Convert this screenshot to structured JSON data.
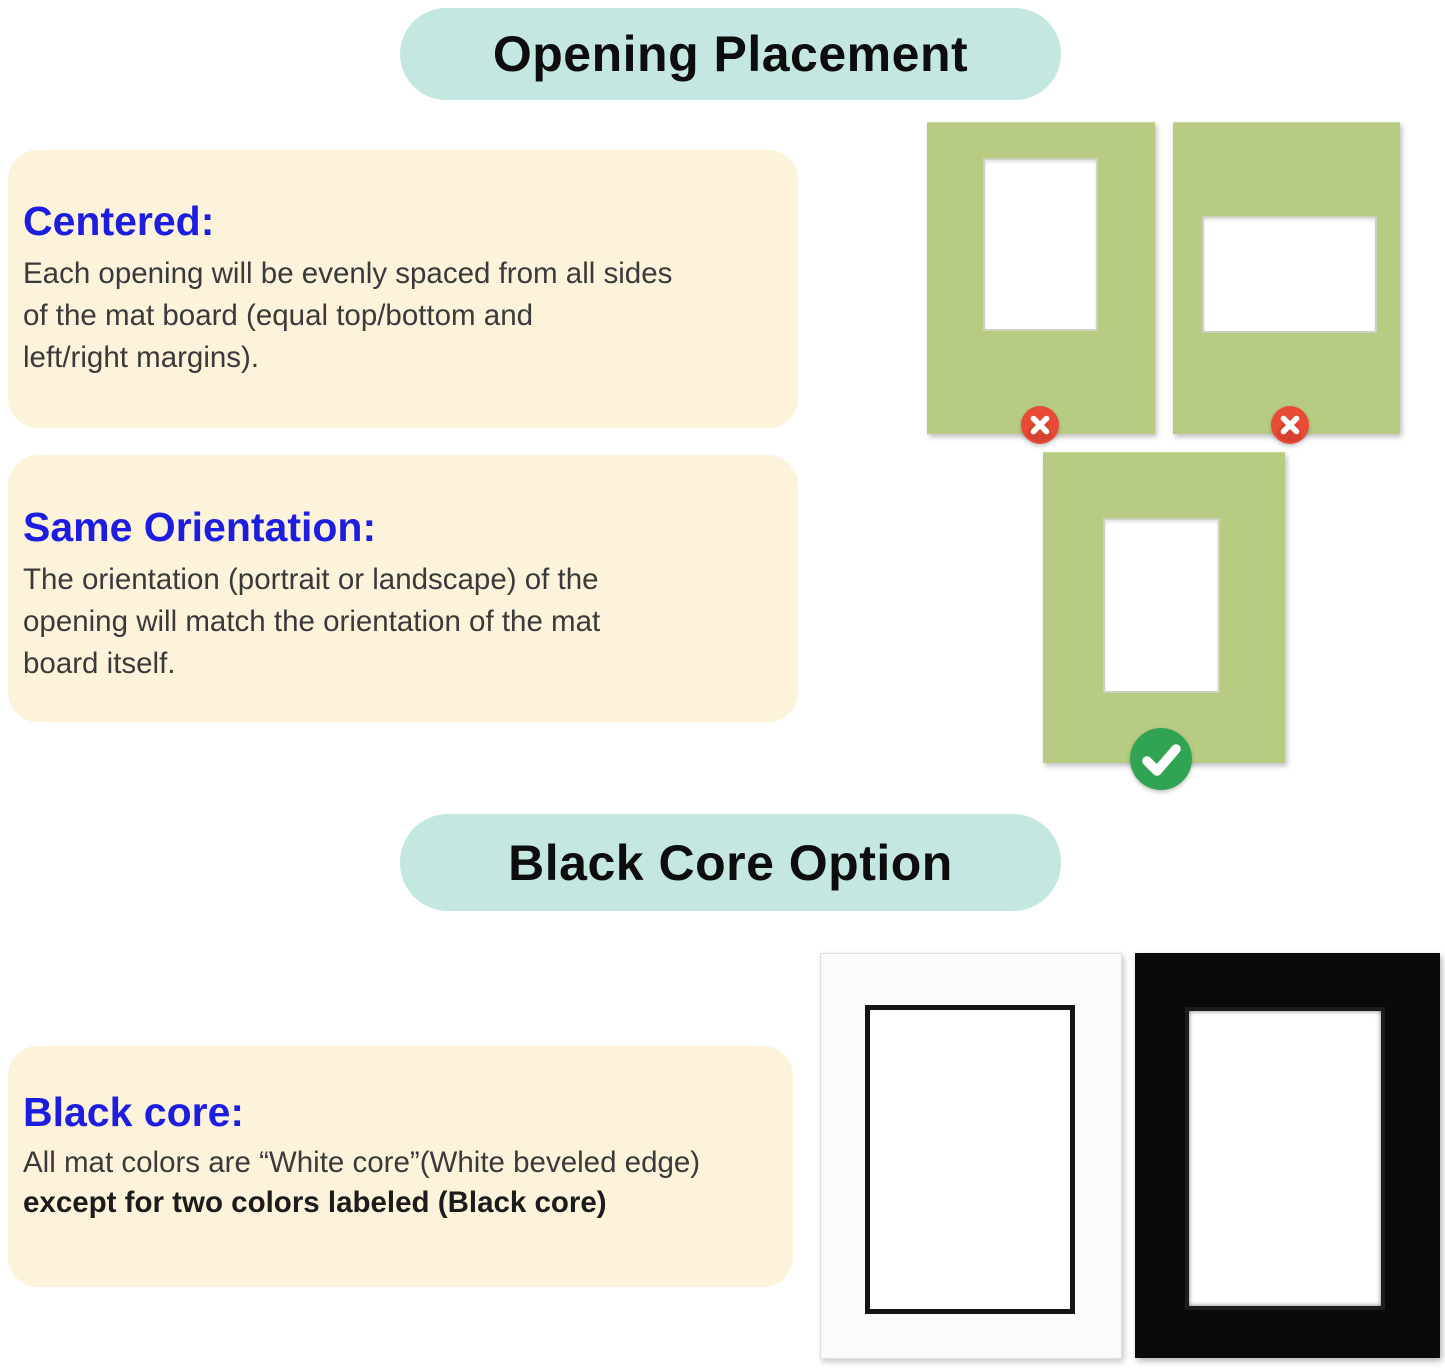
{
  "canvas": {
    "width": 1445,
    "height": 1368,
    "background": "#ffffff"
  },
  "colors": {
    "title_pill_bg": "#c4e8e1",
    "title_text": "#0d0d0d",
    "card_bg": "#fcf3da",
    "heading_blue": "#1d1ddf",
    "body_text": "#3a3a3a",
    "mat_green": "#b7cc82",
    "error_red": "#e74b35",
    "success_green": "#30a452",
    "mat_white": "#fbfbfb",
    "mat_black": "#0a0a0a",
    "black_bevel": "#141414"
  },
  "opening_placement": {
    "title": "Opening Placement",
    "centered": {
      "heading": "Centered:",
      "lines": [
        "Each opening will be evenly spaced from all sides",
        "of the mat board (equal top/bottom and",
        "left/right margins)."
      ]
    },
    "same_orientation": {
      "heading": "Same Orientation:",
      "lines": [
        "The orientation (portrait or landscape) of the",
        "opening will match the orientation of the mat",
        "board itself."
      ]
    }
  },
  "black_core": {
    "title": "Black Core Option",
    "note": {
      "heading": "Black core:",
      "line_regular": "All mat colors are “White core”(White beveled edge)",
      "line_bold": "except for two colors labeled (Black core)"
    }
  },
  "icons": {
    "wrong_icon": "x-mark",
    "correct_icon": "check-mark"
  }
}
